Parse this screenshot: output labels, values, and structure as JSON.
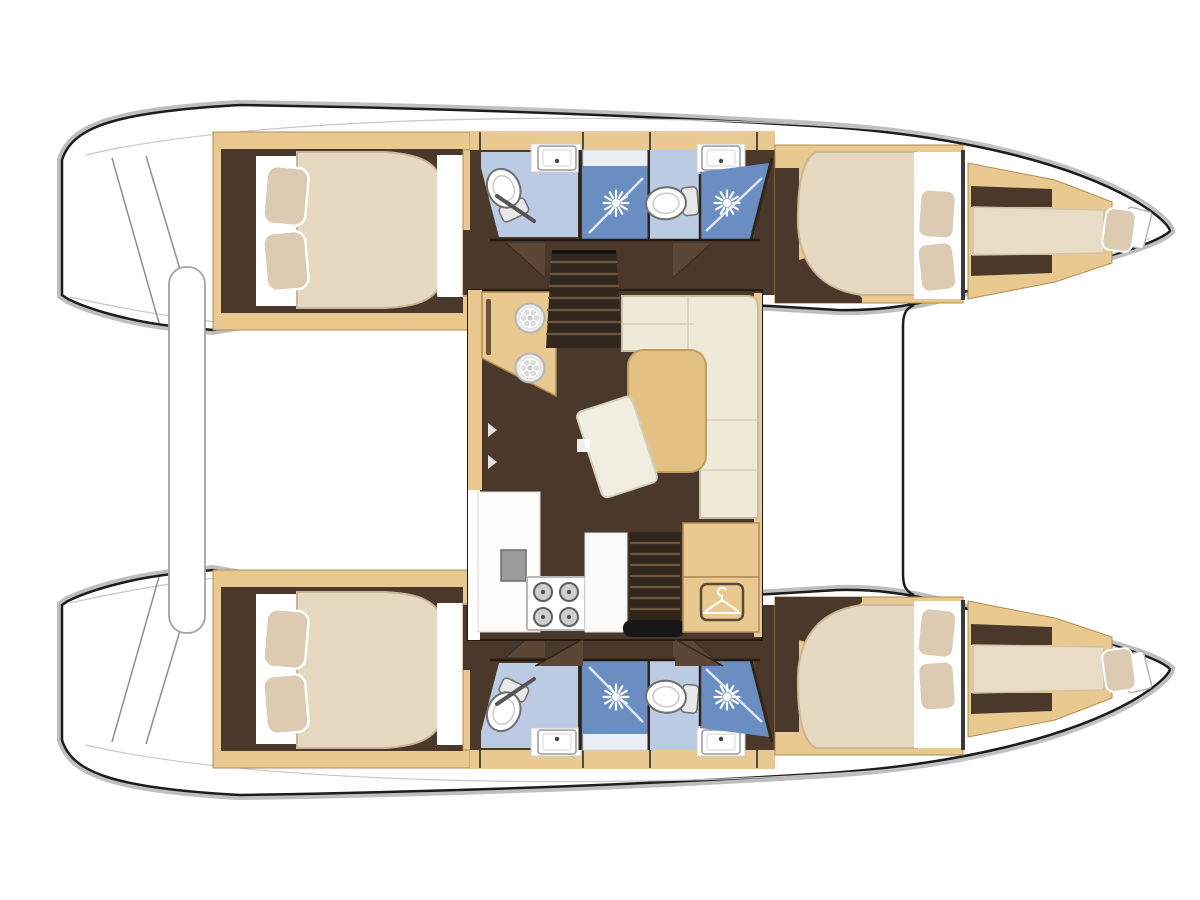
{
  "image": {
    "kind": "boat-floor-plan",
    "subject": "catamaran accommodation deck plan, top view",
    "orientation": "bows pointing right, transom steps at left",
    "visible_text": ""
  },
  "colors": {
    "deck": "#ffffff",
    "outline": "#1c1c1c",
    "glow": "#b3b3b3",
    "sketch": "#c6c6c6",
    "wood": "#e9c98f",
    "wood-edge": "#b08d55",
    "wood-slot": "#6b5335",
    "interior-dark": "#4a382b",
    "wedge": "#5c4737",
    "wall": "#2f2519",
    "mattress": "#e6d8c1",
    "mattress-edge": "#c9b699",
    "berth": "#e9dcc6",
    "pillow": "#dccab3",
    "bath-floor": "#bccbe4",
    "shower-floor": "#6a8ec2",
    "glass": "#dfe8f4",
    "fixture-stroke": "#9a9a9a",
    "sofa": "#efe9d8",
    "sofa-edge": "#c8bea8",
    "sofa-seam": "#d8cfba",
    "table": "#e3c084",
    "table-edge": "#c49d60",
    "stairs": "#32271c",
    "stair-tread": "#6e563f",
    "steel": "#9b9b9b",
    "black": "#171717"
  },
  "vessel": {
    "hulls": 2,
    "double_cabins": 4,
    "shower_rooms": 4,
    "forepeak_berths": 2,
    "per_hull_features": {
      "stern": [
        "transom-steps"
      ],
      "aft_cabin": [
        "island-double-bed",
        "two-pillows",
        "white-bed-platform",
        "foot-locker"
      ],
      "midship_heads": [
        "toilet",
        "sink",
        "shower-stall-with-rose",
        "glass-screen",
        "second-toilet",
        "second-sink",
        "second-shower-stall"
      ],
      "forward_cabin": [
        "island-double-bed",
        "two-pillows"
      ],
      "forepeak": [
        "single-berth",
        "pillow",
        "bow-locker-hatch"
      ]
    },
    "saloon_features": {
      "galley": [
        "counter-with-twin-round-sinks",
        "fiddle-slot",
        "lower-counter",
        "appliance",
        "four-burner-stove",
        "walkway"
      ],
      "dinette": [
        "l-shaped-sofa",
        "wood-table",
        "lounge-pad",
        "small-tray"
      ],
      "storage": [
        "cabinet",
        "wardrobe-with-hanger-symbol"
      ],
      "access": [
        "forward-companionway-stairs",
        "aft-companionway-stairs",
        "door-swings"
      ]
    },
    "between_hulls": [
      "stern-platform-beam",
      "cockpit-area-blank",
      "forward-crossbeam",
      "trampoline-area-blank"
    ]
  }
}
